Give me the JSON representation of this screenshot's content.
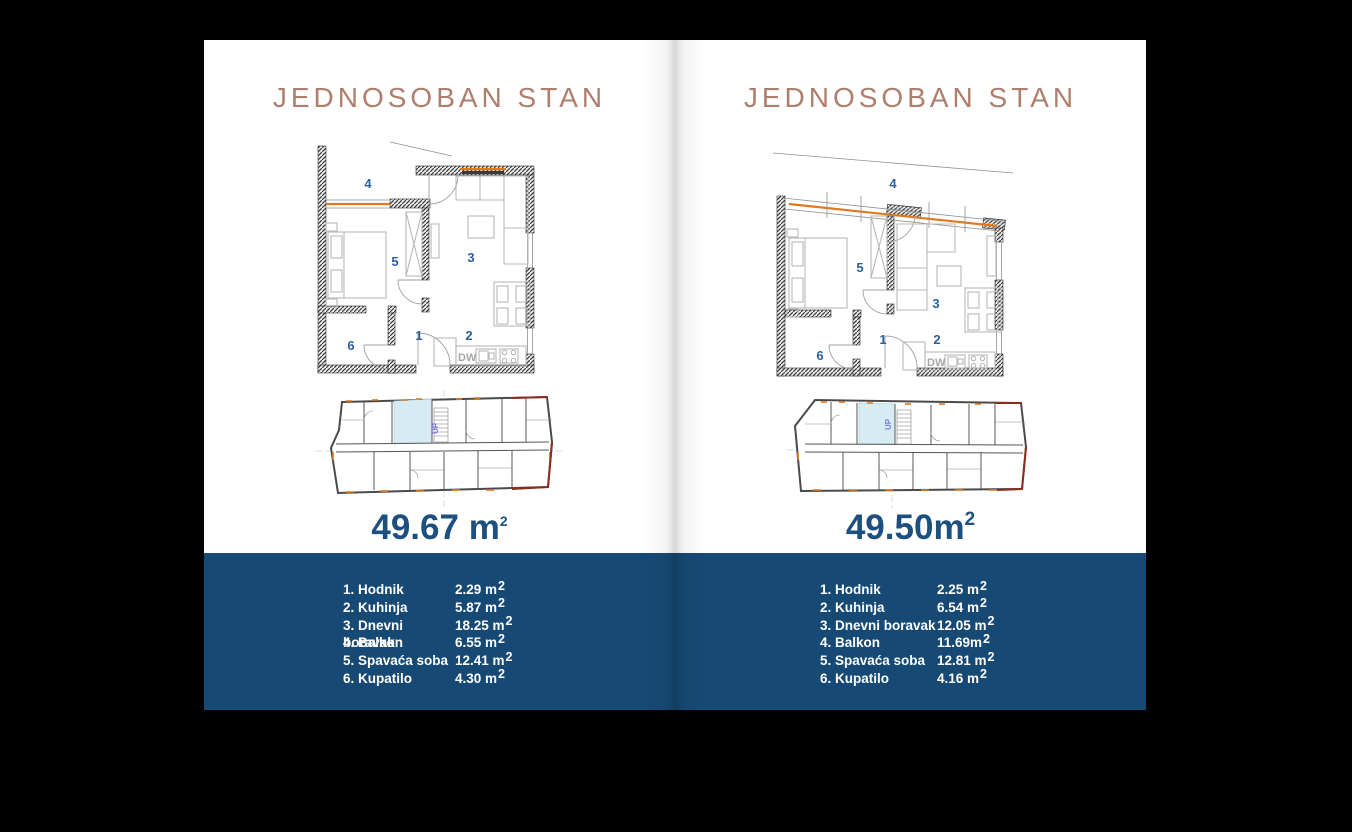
{
  "colors": {
    "page_background": "#ffffff",
    "outer_background": "#000000",
    "title_copper": "#ae7f6c",
    "area_navy": "#1d4f7f",
    "band_blue": "#164a74",
    "room_number_blue": "#2c5fa2",
    "plan_orange": "#e07a1e",
    "site_highlight": "#d7ebf3",
    "legend_text": "#ffffff"
  },
  "pages": [
    {
      "title": "JEDNOSOBAN STAN",
      "area": {
        "value": "49.67",
        "unit": " m",
        "sup": "2"
      },
      "plan": {
        "rooms": [
          "1",
          "2",
          "3",
          "4",
          "5",
          "6"
        ],
        "dw_label": "DW"
      },
      "site": {
        "stair_label": "UP"
      },
      "legend": [
        {
          "label": "1. Hodnik",
          "value": "2.29 m",
          "sup": "2"
        },
        {
          "label": "2. Kuhinja",
          "value": "5.87 m",
          "sup": "2"
        },
        {
          "label": "3. Dnevni boravak",
          "value": "18.25 m",
          "sup": "2"
        },
        {
          "label": "4. Balkon",
          "value": "6.55 m",
          "sup": "2"
        },
        {
          "label": "5. Spavaća soba",
          "value": "12.41 m",
          "sup": "2"
        },
        {
          "label": "6. Kupatilo",
          "value": "4.30 m",
          "sup": "2"
        }
      ]
    },
    {
      "title": "JEDNOSOBAN STAN",
      "area": {
        "value": "49.50",
        "unit": "m",
        "sup": "2"
      },
      "plan": {
        "rooms": [
          "1",
          "2",
          "3",
          "4",
          "5",
          "6"
        ],
        "dw_label": "DW"
      },
      "site": {
        "stair_label": "UP"
      },
      "legend": [
        {
          "label": "1. Hodnik",
          "value": "2.25 m",
          "sup": "2"
        },
        {
          "label": "2. Kuhinja",
          "value": "6.54 m",
          "sup": "2"
        },
        {
          "label": "3. Dnevni boravak",
          "value": "12.05 m",
          "sup": "2"
        },
        {
          "label": "4. Balkon",
          "value": "11.69m",
          "sup": "2"
        },
        {
          "label": "5. Spavaća soba",
          "value": "12.81 m",
          "sup": "2"
        },
        {
          "label": "6. Kupatilo",
          "value": "4.16 m",
          "sup": "2"
        }
      ]
    }
  ]
}
